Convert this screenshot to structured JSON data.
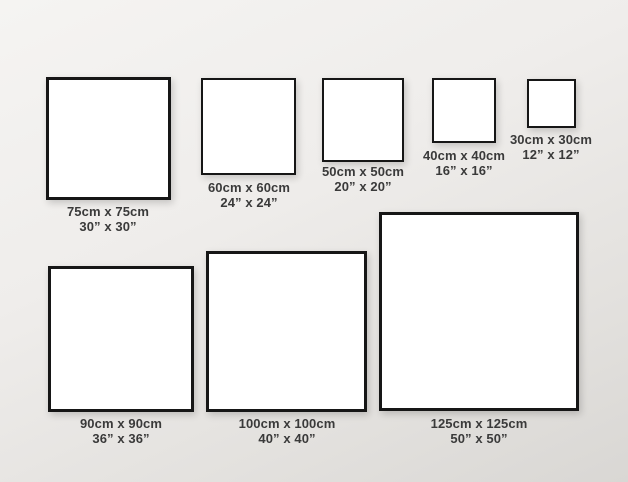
{
  "diagram": {
    "description": "Square canvas size comparison chart",
    "background_top_color": "#f5f4f2",
    "background_bottom_color": "#d9d7d4",
    "frame_border_color": "#161616",
    "frame_fill_color": "#ffffff",
    "label_color": "#3a3a3a"
  },
  "frames": [
    {
      "cm_size": 75,
      "inch_size": 30,
      "cm_label": "75cm x 75cm",
      "inch_label": "30” x 30”"
    },
    {
      "cm_size": 60,
      "inch_size": 24,
      "cm_label": "60cm x 60cm",
      "inch_label": "24” x 24”"
    },
    {
      "cm_size": 50,
      "inch_size": 20,
      "cm_label": "50cm x 50cm",
      "inch_label": "20” x 20”"
    },
    {
      "cm_size": 40,
      "inch_size": 16,
      "cm_label": "40cm x 40cm",
      "inch_label": "16” x 16”"
    },
    {
      "cm_size": 30,
      "inch_size": 12,
      "cm_label": "30cm x 30cm",
      "inch_label": "12” x 12”"
    },
    {
      "cm_size": 90,
      "inch_size": 36,
      "cm_label": "90cm x 90cm",
      "inch_label": "36” x 36”"
    },
    {
      "cm_size": 100,
      "inch_size": 40,
      "cm_label": "100cm x 100cm",
      "inch_label": "40” x 40”"
    },
    {
      "cm_size": 125,
      "inch_size": 50,
      "cm_label": "125cm x 125cm",
      "inch_label": "50” x 50”"
    }
  ]
}
